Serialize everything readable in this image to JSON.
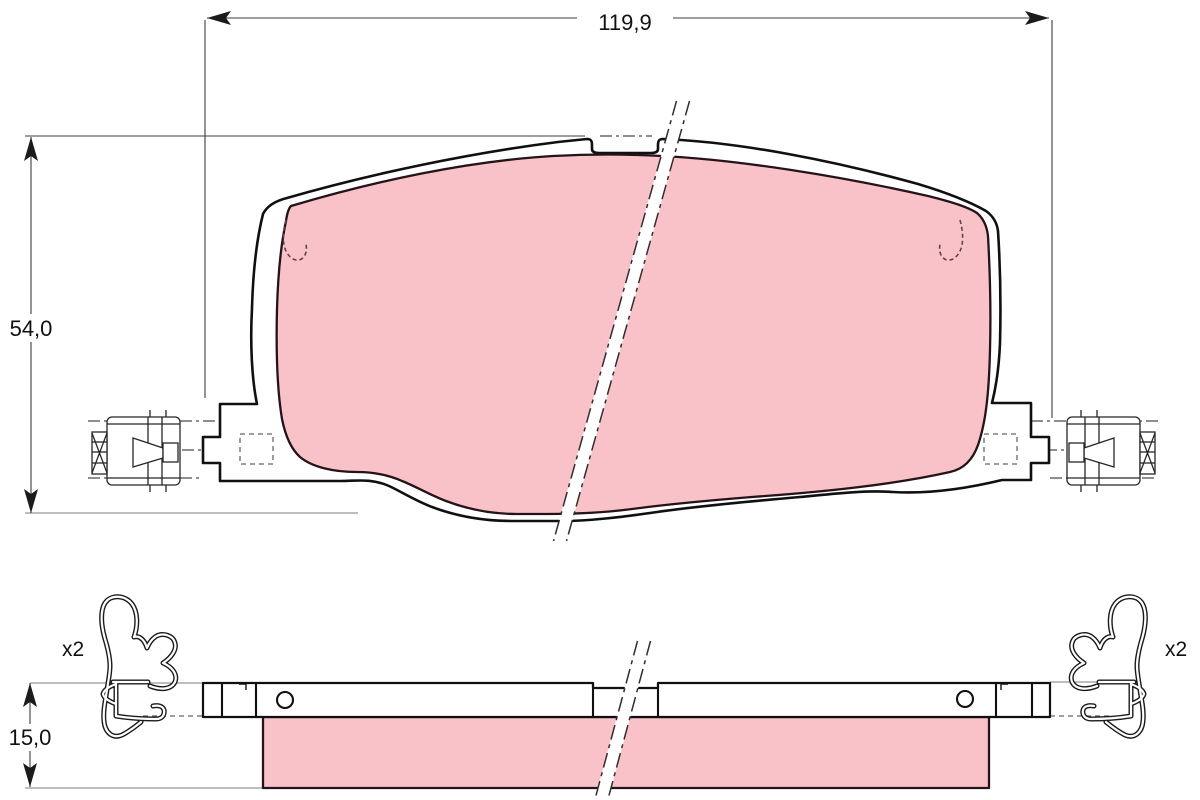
{
  "drawing": {
    "dimensions": {
      "overall_width": "119,9",
      "overall_height": "54,0",
      "total_thickness": "15,0"
    },
    "labels": {
      "left_clip_qty": "x2",
      "right_clip_qty": "x2"
    },
    "colors": {
      "friction_material": "#f9c2c8",
      "outline": "#141414",
      "dimension_line": "#3c3c3c",
      "reference_line": "#7d7d7d",
      "background": "#ffffff"
    }
  }
}
